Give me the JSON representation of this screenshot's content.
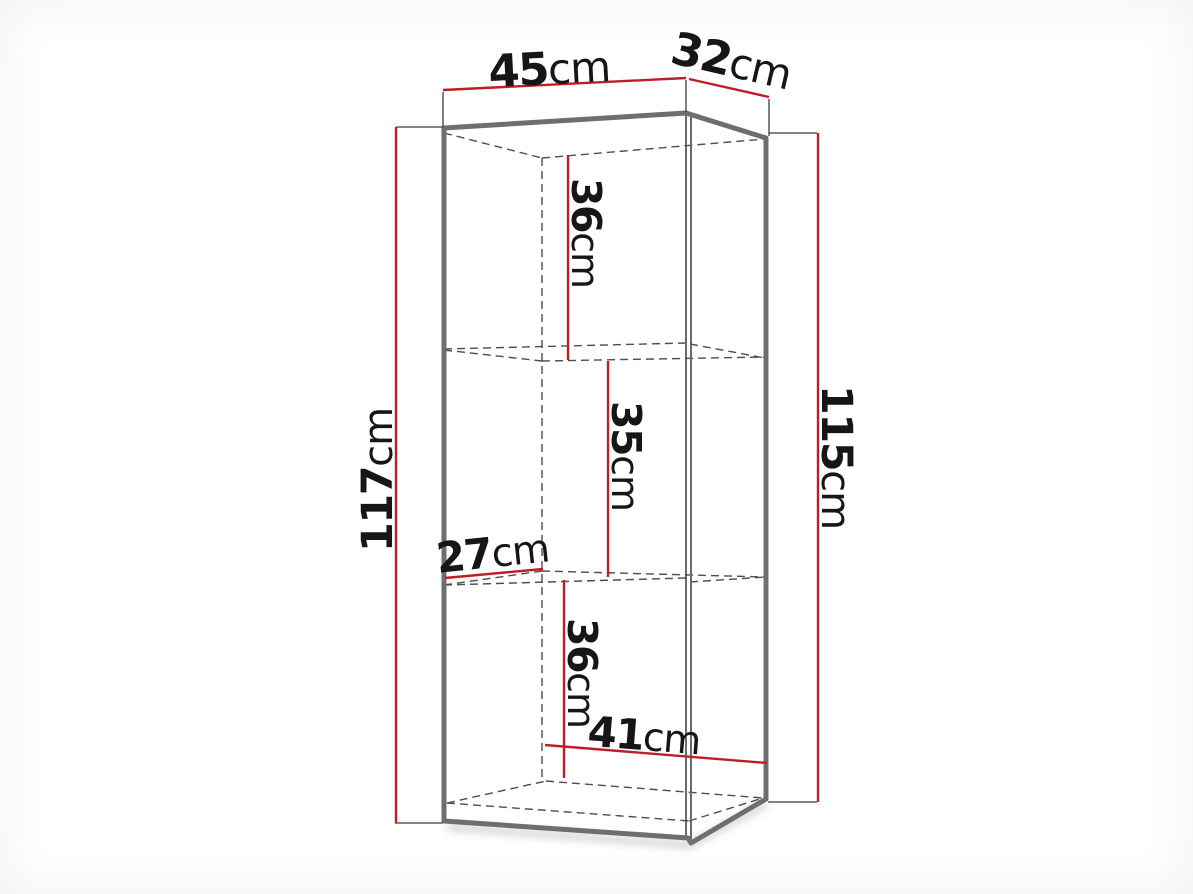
{
  "diagram": {
    "unit": "cm",
    "colors": {
      "dimension-red": "#bd1f27",
      "edge-gray": "#6e6e6e",
      "hidden-line-gray": "#4d4d4d",
      "label-black": "#161616"
    },
    "dimensions": {
      "front_width": {
        "value": "45",
        "unit": "cm"
      },
      "top_depth": {
        "value": "32",
        "unit": "cm"
      },
      "left_height": {
        "value": "117",
        "unit": "cm"
      },
      "right_height": {
        "value": "115",
        "unit": "cm"
      },
      "upper_compartment_height": {
        "value": "36",
        "unit": "cm"
      },
      "middle_compartment_height": {
        "value": "35",
        "unit": "cm"
      },
      "interior_depth": {
        "value": "27",
        "unit": "cm"
      },
      "lower_compartment_height": {
        "value": "36",
        "unit": "cm"
      },
      "interior_width": {
        "value": "41",
        "unit": "cm"
      }
    }
  }
}
